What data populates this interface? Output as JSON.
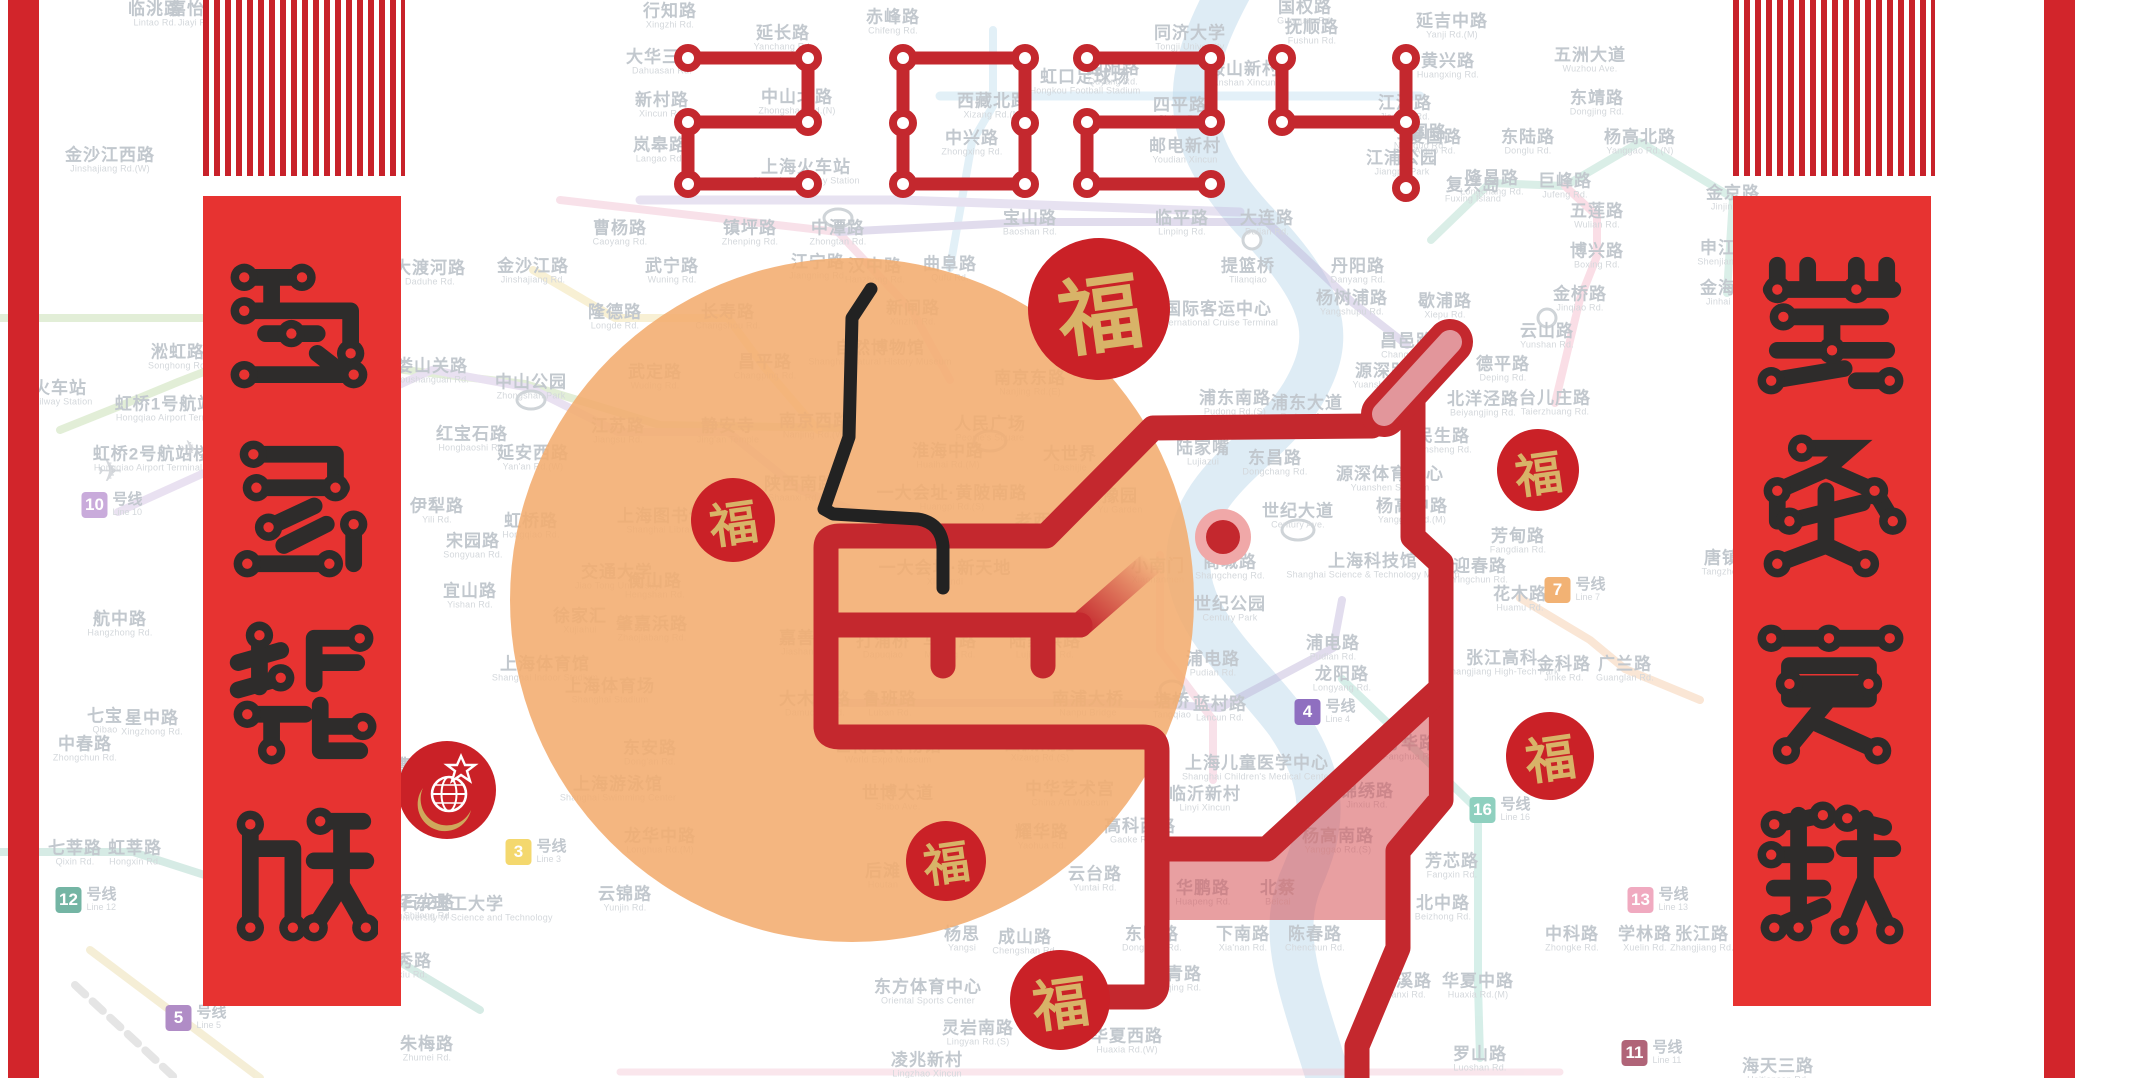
{
  "title": {
    "year": "2024"
  },
  "banners": {
    "left": {
      "text": "龍馬精神"
    },
    "right": {
      "text": "萬象更新"
    }
  },
  "fu": {
    "label": "福"
  },
  "colors": {
    "dragon_red": "#c4282e",
    "banner_red": "#e73331",
    "edge_red": "#d2252b",
    "orange_sun": "#f3ac6e",
    "pink_fill": "#d65054",
    "gold": "#d8b368",
    "whisker_black": "#222222"
  },
  "line_badges": [
    {
      "num": "10",
      "cn": "号线",
      "en": "Line 10",
      "x": 112,
      "y": 505,
      "color": "#c9abdb"
    },
    {
      "num": "12",
      "cn": "号线",
      "en": "Line 12",
      "x": 86,
      "y": 900,
      "color": "#74b5a4"
    },
    {
      "num": "1",
      "cn": "号线",
      "en": "Line 1",
      "x": 312,
      "y": 988,
      "color": "#e86a74"
    },
    {
      "num": "5",
      "cn": "号线",
      "en": "Line 5",
      "x": 196,
      "y": 1018,
      "color": "#b08cc6"
    },
    {
      "num": "3",
      "cn": "号线",
      "en": "Line 3",
      "x": 536,
      "y": 852,
      "color": "#f4d86e"
    },
    {
      "num": "4",
      "cn": "号线",
      "en": "Line 4",
      "x": 1325,
      "y": 712,
      "color": "#8f6fc0"
    },
    {
      "num": "7",
      "cn": "号线",
      "en": "Line 7",
      "x": 1575,
      "y": 590,
      "color": "#f2b274"
    },
    {
      "num": "16",
      "cn": "号线",
      "en": "Line 16",
      "x": 1500,
      "y": 810,
      "color": "#8fd0bf"
    },
    {
      "num": "13",
      "cn": "号线",
      "en": "Line 13",
      "x": 1658,
      "y": 900,
      "color": "#f0aac0"
    },
    {
      "num": "11",
      "cn": "号线",
      "en": "Line 11",
      "x": 1652,
      "y": 1053,
      "color": "#b06478"
    }
  ],
  "stations": [
    {
      "cn": "临洮路",
      "en": "Lintao Rd.",
      "x": 155,
      "y": 14
    },
    {
      "cn": "嘉怡路",
      "en": "Jiayi Rd.",
      "x": 196,
      "y": 14
    },
    {
      "cn": "行知路",
      "en": "Xingzhi Rd.",
      "x": 670,
      "y": 16
    },
    {
      "cn": "延长路",
      "en": "Yanchang Rd.",
      "x": 783,
      "y": 38
    },
    {
      "cn": "赤峰路",
      "en": "Chifeng Rd.",
      "x": 893,
      "y": 22
    },
    {
      "cn": "国权路",
      "en": "Guoquan Rd.",
      "x": 1305,
      "y": 12
    },
    {
      "cn": "抚顺路",
      "en": "Fushun Rd.",
      "x": 1312,
      "y": 32
    },
    {
      "cn": "延吉中路",
      "en": "Yanji Rd.(M)",
      "x": 1452,
      "y": 26
    },
    {
      "cn": "同济大学",
      "en": "Tongji University",
      "x": 1190,
      "y": 38
    },
    {
      "cn": "大华三路",
      "en": "Dahuasan Rd.",
      "x": 662,
      "y": 62
    },
    {
      "cn": "黄兴路",
      "en": "Huangxing Rd.",
      "x": 1448,
      "y": 66
    },
    {
      "cn": "鞍山新村",
      "en": "Anshan Xincun",
      "x": 1244,
      "y": 74
    },
    {
      "cn": "新村路",
      "en": "Xincun Rd.",
      "x": 662,
      "y": 105
    },
    {
      "cn": "中山北路",
      "en": "Zhongshan Rd.(N)",
      "x": 797,
      "y": 102
    },
    {
      "cn": "西藏北路",
      "en": "Xizang Rd.(N)",
      "x": 993,
      "y": 106
    },
    {
      "cn": "虹口足球场",
      "en": "Hongkou Football Stadium",
      "x": 1085,
      "y": 82
    },
    {
      "cn": "曲阳路",
      "en": "Quyang Rd.",
      "x": 1113,
      "y": 73
    },
    {
      "cn": "四平路",
      "en": "Siping Rd.",
      "x": 1180,
      "y": 110
    },
    {
      "cn": "江浦路",
      "en": "Jiangpu Rd.",
      "x": 1405,
      "y": 108
    },
    {
      "cn": "宁国路",
      "en": "Ningguo Rd.",
      "x": 1420,
      "y": 137
    },
    {
      "cn": "爱国路",
      "en": "Aiguo Rd.",
      "x": 1435,
      "y": 142
    },
    {
      "cn": "东陆路",
      "en": "Donglu Rd.",
      "x": 1528,
      "y": 142
    },
    {
      "cn": "杨高北路",
      "en": "Yanggao Rd.(N)",
      "x": 1640,
      "y": 142
    },
    {
      "cn": "五洲大道",
      "en": "Wuzhou Ave.",
      "x": 1590,
      "y": 60
    },
    {
      "cn": "东靖路",
      "en": "Dongjing Rd.",
      "x": 1597,
      "y": 103
    },
    {
      "cn": "岚皋路",
      "en": "Langao Rd.",
      "x": 660,
      "y": 150
    },
    {
      "cn": "上海火车站",
      "en": "Shanghai Railway Station",
      "x": 806,
      "y": 172
    },
    {
      "cn": "中兴路",
      "en": "Zhongxing Rd.",
      "x": 972,
      "y": 143
    },
    {
      "cn": "邮电新村",
      "en": "Youdian Xincun",
      "x": 1185,
      "y": 151
    },
    {
      "cn": "江浦公园",
      "en": "Jiangpu Park",
      "x": 1402,
      "y": 163
    },
    {
      "cn": "隆昌路",
      "en": "Longchang Rd.",
      "x": 1492,
      "y": 183
    },
    {
      "cn": "复兴岛",
      "en": "Fuxing Island",
      "x": 1473,
      "y": 190
    },
    {
      "cn": "巨峰路",
      "en": "Jufeng Rd.",
      "x": 1565,
      "y": 186
    },
    {
      "cn": "金京路",
      "en": "Jinjing Rd.",
      "x": 1733,
      "y": 198
    },
    {
      "cn": "申江路",
      "en": "Shenjiang Rd.",
      "x": 1727,
      "y": 253
    },
    {
      "cn": "金海路",
      "en": "Jinhai Rd.",
      "x": 1727,
      "y": 293
    },
    {
      "cn": "五莲路",
      "en": "Wulian Rd.",
      "x": 1597,
      "y": 216
    },
    {
      "cn": "博兴路",
      "en": "Boxing Rd.",
      "x": 1597,
      "y": 256
    },
    {
      "cn": "金沙江西路",
      "en": "Jinshajiang Rd.(W)",
      "x": 110,
      "y": 160
    },
    {
      "cn": "曹杨路",
      "en": "Caoyang Rd.",
      "x": 620,
      "y": 233
    },
    {
      "cn": "镇坪路",
      "en": "Zhenping Rd.",
      "x": 750,
      "y": 233
    },
    {
      "cn": "中潭路",
      "en": "Zhongtan Rd.",
      "x": 838,
      "y": 233
    },
    {
      "cn": "江宁路",
      "en": "Jiangning Rd.",
      "x": 818,
      "y": 267
    },
    {
      "cn": "大渡河路",
      "en": "Daduhe Rd.",
      "x": 430,
      "y": 273
    },
    {
      "cn": "金沙江路",
      "en": "Jinshajiang Rd.",
      "x": 533,
      "y": 271
    },
    {
      "cn": "武宁路",
      "en": "Wuning Rd.",
      "x": 672,
      "y": 271
    },
    {
      "cn": "隆德路",
      "en": "Longde Rd.",
      "x": 615,
      "y": 317
    },
    {
      "cn": "长寿路",
      "en": "Changshou Rd.",
      "x": 728,
      "y": 317
    },
    {
      "cn": "昌平路",
      "en": "Changping Rd.",
      "x": 765,
      "y": 367
    },
    {
      "cn": "武定路",
      "en": "Wuding Rd.",
      "x": 655,
      "y": 377
    },
    {
      "cn": "中山公园",
      "en": "Zhongshan Park",
      "x": 531,
      "y": 387
    },
    {
      "cn": "娄山关路",
      "en": "Loushanguan Rd.",
      "x": 432,
      "y": 371
    },
    {
      "cn": "江苏路",
      "en": "Jiangsu Rd.",
      "x": 618,
      "y": 431
    },
    {
      "cn": "静安寺",
      "en": "Jing'an Temple",
      "x": 728,
      "y": 431
    },
    {
      "cn": "红宝石路",
      "en": "Hongbaoshi Rd.",
      "x": 472,
      "y": 439
    },
    {
      "cn": "延安西路",
      "en": "Yan'an Rd.(W)",
      "x": 533,
      "y": 458
    },
    {
      "cn": "伊犁路",
      "en": "Yili Rd.",
      "x": 437,
      "y": 511
    },
    {
      "cn": "虹桥路",
      "en": "Hongqiao Rd.",
      "x": 531,
      "y": 526
    },
    {
      "cn": "宋园路",
      "en": "Songyuan Rd.",
      "x": 473,
      "y": 546
    },
    {
      "cn": "上海图书馆",
      "en": "Shanghai Library",
      "x": 662,
      "y": 521
    },
    {
      "cn": "交通大学",
      "en": "Jiao Tong University",
      "x": 617,
      "y": 577
    },
    {
      "cn": "陕西南路",
      "en": "Shaanxi Rd.(S)",
      "x": 800,
      "y": 489
    },
    {
      "cn": "汉中路",
      "en": "Hanzhong Rd.",
      "x": 875,
      "y": 271
    },
    {
      "cn": "新闸路",
      "en": "Xinzha Rd.",
      "x": 913,
      "y": 313
    },
    {
      "cn": "曲阜路",
      "en": "Qufu Rd.",
      "x": 950,
      "y": 269
    },
    {
      "cn": "自然博物馆",
      "en": "Shanghai Natural History Museum",
      "x": 880,
      "y": 353
    },
    {
      "cn": "南京西路",
      "en": "Nanjing Rd.(W)",
      "x": 815,
      "y": 426
    },
    {
      "cn": "南京东路",
      "en": "Nanjing Rd.(E)",
      "x": 1030,
      "y": 383
    },
    {
      "cn": "人民广场",
      "en": "People's Square",
      "x": 990,
      "y": 429
    },
    {
      "cn": "淮海中路",
      "en": "Huaihai Rd.(M)",
      "x": 948,
      "y": 456
    },
    {
      "cn": "大世界",
      "en": "Dashijie",
      "x": 1070,
      "y": 459
    },
    {
      "cn": "一大会址·黄陂南路",
      "en": "Huangpi Rd.(S)",
      "x": 952,
      "y": 498
    },
    {
      "cn": "一大会址·新天地",
      "en": "Xintiandi",
      "x": 945,
      "y": 573
    },
    {
      "cn": "老西门",
      "en": "Laoximen",
      "x": 1042,
      "y": 526
    },
    {
      "cn": "豫园",
      "en": "Yu Garden",
      "x": 1120,
      "y": 501
    },
    {
      "cn": "小南门",
      "en": "Xiaonanmen",
      "x": 1158,
      "y": 571
    },
    {
      "cn": "宝山路",
      "en": "Baoshan Rd.",
      "x": 1030,
      "y": 223
    },
    {
      "cn": "临平路",
      "en": "Linping Rd.",
      "x": 1182,
      "y": 223
    },
    {
      "cn": "大连路",
      "en": "Dalian Rd.",
      "x": 1267,
      "y": 223
    },
    {
      "cn": "提篮桥",
      "en": "Tilanqiao",
      "x": 1248,
      "y": 271
    },
    {
      "cn": "国际客运中心",
      "en": "International Cruise Terminal",
      "x": 1218,
      "y": 314
    },
    {
      "cn": "丹阳路",
      "en": "Danyang Rd.",
      "x": 1358,
      "y": 271
    },
    {
      "cn": "杨树浦路",
      "en": "Yangshupu Rd.",
      "x": 1352,
      "y": 303
    },
    {
      "cn": "歇浦路",
      "en": "Xiepu Rd.",
      "x": 1445,
      "y": 306
    },
    {
      "cn": "金桥路",
      "en": "Jinqiao Rd.",
      "x": 1580,
      "y": 299
    },
    {
      "cn": "昌邑路",
      "en": "Changyi Rd.",
      "x": 1407,
      "y": 346
    },
    {
      "cn": "源深路",
      "en": "Yuanshen Rd.",
      "x": 1382,
      "y": 376
    },
    {
      "cn": "云山路",
      "en": "Yunshan Rd.",
      "x": 1547,
      "y": 336
    },
    {
      "cn": "德平路",
      "en": "Deping Rd.",
      "x": 1503,
      "y": 369
    },
    {
      "cn": "北洋泾路",
      "en": "Beiyangjing Rd.",
      "x": 1483,
      "y": 404
    },
    {
      "cn": "民生路",
      "en": "Minsheng Rd.",
      "x": 1443,
      "y": 441
    },
    {
      "cn": "源深体育中心",
      "en": "Yuanshen Stadium",
      "x": 1390,
      "y": 479
    },
    {
      "cn": "杨高中路",
      "en": "Yanggao Rd.(M)",
      "x": 1412,
      "y": 511
    },
    {
      "cn": "台儿庄路",
      "en": "Taierzhuang Rd.",
      "x": 1555,
      "y": 403
    },
    {
      "cn": "浦东南路",
      "en": "Pudong Rd.(S)",
      "x": 1235,
      "y": 403
    },
    {
      "cn": "浦东大道",
      "en": "Pudong Ave.",
      "x": 1307,
      "y": 408
    },
    {
      "cn": "陆家嘴",
      "en": "Lujiazui",
      "x": 1203,
      "y": 453
    },
    {
      "cn": "东昌路",
      "en": "Dongchang Rd.",
      "x": 1275,
      "y": 463
    },
    {
      "cn": "世纪大道",
      "en": "Century Ave.",
      "x": 1298,
      "y": 516
    },
    {
      "cn": "商城路",
      "en": "Shangcheng Rd.",
      "x": 1230,
      "y": 567
    },
    {
      "cn": "上海科技馆",
      "en": "Shanghai Science & Technology Museum",
      "x": 1373,
      "y": 566
    },
    {
      "cn": "迎春路",
      "en": "Yingchun Rd.",
      "x": 1480,
      "y": 571
    },
    {
      "cn": "世纪公园",
      "en": "Century Park",
      "x": 1230,
      "y": 609
    },
    {
      "cn": "芳甸路",
      "en": "Fangdian Rd.",
      "x": 1518,
      "y": 541
    },
    {
      "cn": "花木路",
      "en": "Huamu Rd.",
      "x": 1520,
      "y": 599
    },
    {
      "cn": "浦电路",
      "en": "Pudian Rd.",
      "x": 1213,
      "y": 664
    },
    {
      "cn": "浦电路",
      "en": "Pudian Rd.",
      "x": 1333,
      "y": 648
    },
    {
      "cn": "龙阳路",
      "en": "Longyang Rd.",
      "x": 1342,
      "y": 679
    },
    {
      "cn": "张江高科",
      "en": "Zhangjiang High-Tech Park",
      "x": 1502,
      "y": 663
    },
    {
      "cn": "金科路",
      "en": "Jinke Rd.",
      "x": 1564,
      "y": 669
    },
    {
      "cn": "广兰路",
      "en": "Guanglan Rd.",
      "x": 1625,
      "y": 669
    },
    {
      "cn": "中科路",
      "en": "Zhongke Rd.",
      "x": 1572,
      "y": 939
    },
    {
      "cn": "学林路",
      "en": "Xuelin Rd.",
      "x": 1645,
      "y": 939
    },
    {
      "cn": "张江路",
      "en": "Zhangjiang Rd.",
      "x": 1702,
      "y": 939
    },
    {
      "cn": "唐镇",
      "en": "Tangzhen",
      "x": 1722,
      "y": 563
    },
    {
      "cn": "蓝村路",
      "en": "Lancun Rd.",
      "x": 1220,
      "y": 709
    },
    {
      "cn": "塘桥",
      "en": "Tangqiao",
      "x": 1172,
      "y": 706
    },
    {
      "cn": "南浦大桥",
      "en": "Nanpu Bridge",
      "x": 1088,
      "y": 704
    },
    {
      "cn": "鲁班路",
      "en": "Luban Rd.",
      "x": 890,
      "y": 704
    },
    {
      "cn": "大木桥路",
      "en": "Damuqiao Rd.",
      "x": 815,
      "y": 704
    },
    {
      "cn": "嘉善路",
      "en": "Jiashan Rd.",
      "x": 806,
      "y": 643
    },
    {
      "cn": "打浦桥",
      "en": "Dapuqiao",
      "x": 883,
      "y": 646
    },
    {
      "cn": "马当路",
      "en": "Madang Rd.",
      "x": 950,
      "y": 646
    },
    {
      "cn": "陆家浜路",
      "en": "Lujiabang Rd.",
      "x": 1045,
      "y": 646
    },
    {
      "cn": "西藏南路",
      "en": "Xizang Rd.(S)",
      "x": 1040,
      "y": 749
    },
    {
      "cn": "中华艺术宫",
      "en": "China Art Museum",
      "x": 1070,
      "y": 794
    },
    {
      "cn": "世博会博物馆",
      "en": "World Expo Museum",
      "x": 888,
      "y": 751
    },
    {
      "cn": "世博大道",
      "en": "Shibo Ave.",
      "x": 898,
      "y": 798
    },
    {
      "cn": "耀华路",
      "en": "Yaohua Rd.",
      "x": 1042,
      "y": 837
    },
    {
      "cn": "后滩",
      "en": "Houtan",
      "x": 883,
      "y": 876
    },
    {
      "cn": "云台路",
      "en": "Yuntai Rd.",
      "x": 1095,
      "y": 879
    },
    {
      "cn": "高科西路",
      "en": "Gaoke Rd.(W)",
      "x": 1140,
      "y": 831
    },
    {
      "cn": "临沂新村",
      "en": "Linyi Xincun",
      "x": 1205,
      "y": 799
    },
    {
      "cn": "上海儿童医学中心",
      "en": "Shanghai Children's Medical Center",
      "x": 1257,
      "y": 768
    },
    {
      "cn": "芳华路",
      "en": "Fanghua Rd.",
      "x": 1410,
      "y": 748
    },
    {
      "cn": "锦绣路",
      "en": "Jinxiu Rd.",
      "x": 1367,
      "y": 796
    },
    {
      "cn": "杨高南路",
      "en": "Yanggao Rd.(S)",
      "x": 1338,
      "y": 841
    },
    {
      "cn": "芳芯路",
      "en": "Fangxin Rd.",
      "x": 1452,
      "y": 866
    },
    {
      "cn": "北中路",
      "en": "Beizhong Rd.",
      "x": 1443,
      "y": 908
    },
    {
      "cn": "华鹏路",
      "en": "Huapeng Rd.",
      "x": 1203,
      "y": 893
    },
    {
      "cn": "北蔡",
      "en": "Beicai",
      "x": 1278,
      "y": 893
    },
    {
      "cn": "东明路",
      "en": "Dongming Rd.",
      "x": 1152,
      "y": 939
    },
    {
      "cn": "下南路",
      "en": "Xia'nan Rd.",
      "x": 1243,
      "y": 939
    },
    {
      "cn": "陈春路",
      "en": "Chenchun Rd.",
      "x": 1315,
      "y": 939
    },
    {
      "cn": "高青路",
      "en": "Gaoqing Rd.",
      "x": 1175,
      "y": 979
    },
    {
      "cn": "华夏西路",
      "en": "Huaxia Rd.(W)",
      "x": 1127,
      "y": 1041
    },
    {
      "cn": "莲溪路",
      "en": "Lianxi Rd.",
      "x": 1405,
      "y": 986
    },
    {
      "cn": "华夏中路",
      "en": "Huaxia Rd.(M)",
      "x": 1478,
      "y": 986
    },
    {
      "cn": "罗山路",
      "en": "Luoshan Rd.",
      "x": 1480,
      "y": 1059
    },
    {
      "cn": "成山路",
      "en": "Chengshan Rd.",
      "x": 1025,
      "y": 942
    },
    {
      "cn": "杨思",
      "en": "Yangsi",
      "x": 962,
      "y": 939
    },
    {
      "cn": "东方体育中心",
      "en": "Oriental Sports Center",
      "x": 928,
      "y": 992
    },
    {
      "cn": "灵岩南路",
      "en": "Lingyan Rd.(S)",
      "x": 978,
      "y": 1033
    },
    {
      "cn": "凌兆新村",
      "en": "Lingzhao Xincun",
      "x": 927,
      "y": 1065
    },
    {
      "cn": "徐家汇",
      "en": "Xujiahui",
      "x": 580,
      "y": 621
    },
    {
      "cn": "肇嘉浜路",
      "en": "Zhaojiabang Rd.",
      "x": 652,
      "y": 629
    },
    {
      "cn": "衡山路",
      "en": "Hengshan Rd.",
      "x": 655,
      "y": 586
    },
    {
      "cn": "宜山路",
      "en": "Yishan Rd.",
      "x": 470,
      "y": 596
    },
    {
      "cn": "上海体育馆",
      "en": "Shanghai Indoor Stadium",
      "x": 545,
      "y": 669
    },
    {
      "cn": "上海体育场",
      "en": "Shanghai Stadium",
      "x": 610,
      "y": 691
    },
    {
      "cn": "东安路",
      "en": "Dong'an Rd.",
      "x": 650,
      "y": 753
    },
    {
      "cn": "上海游泳馆",
      "en": "Shanghai Swimming Center",
      "x": 618,
      "y": 789
    },
    {
      "cn": "龙华中路",
      "en": "Longhua Rd.(M)",
      "x": 660,
      "y": 841
    },
    {
      "cn": "云锦路",
      "en": "Yunjin Rd.",
      "x": 625,
      "y": 899
    },
    {
      "cn": "石龙路",
      "en": "Shilong Rd.",
      "x": 428,
      "y": 907
    },
    {
      "cn": "上海南站",
      "en": "Shanghai South Railway Station",
      "x": 360,
      "y": 752
    },
    {
      "cn": "漕宝路",
      "en": "Caobao Rd.",
      "x": 420,
      "y": 771
    },
    {
      "cn": "锦江乐园",
      "en": "Jinjiang Park",
      "x": 298,
      "y": 906
    },
    {
      "cn": "莘庄",
      "en": "Xinzhuang",
      "x": 262,
      "y": 983
    },
    {
      "cn": "罗秀路",
      "en": "Luoxiu Rd.",
      "x": 405,
      "y": 966
    },
    {
      "cn": "华东理工大学",
      "en": "East China University of Science and Technology",
      "x": 450,
      "y": 909
    },
    {
      "cn": "朱梅路",
      "en": "Zhumei Rd.",
      "x": 427,
      "y": 1049
    },
    {
      "cn": "航中路",
      "en": "Hangzhong Rd.",
      "x": 120,
      "y": 624
    },
    {
      "cn": "七宝",
      "en": "Qibao",
      "x": 105,
      "y": 721
    },
    {
      "cn": "星中路",
      "en": "Xingzhong Rd.",
      "x": 152,
      "y": 723
    },
    {
      "cn": "中春路",
      "en": "Zhongchun Rd.",
      "x": 85,
      "y": 749
    },
    {
      "cn": "七莘路",
      "en": "Qixin Rd.",
      "x": 75,
      "y": 853
    },
    {
      "cn": "虹莘路",
      "en": "Hongxin Rd.",
      "x": 135,
      "y": 853
    },
    {
      "cn": "淞虹路",
      "en": "Songhong Rd.",
      "x": 178,
      "y": 357
    },
    {
      "cn": "虹桥1号航站楼",
      "en": "Hongqiao Airport Terminal 1",
      "x": 174,
      "y": 409
    },
    {
      "cn": "虹桥2号航站楼",
      "en": "Hongqiao Airport Terminal 2",
      "x": 152,
      "y": 459
    },
    {
      "cn": "火车站",
      "en": "Railway Station",
      "x": 60,
      "y": 393
    },
    {
      "cn": "海天三路",
      "en": "Haitiansan Rd.",
      "x": 1778,
      "y": 1071
    }
  ]
}
